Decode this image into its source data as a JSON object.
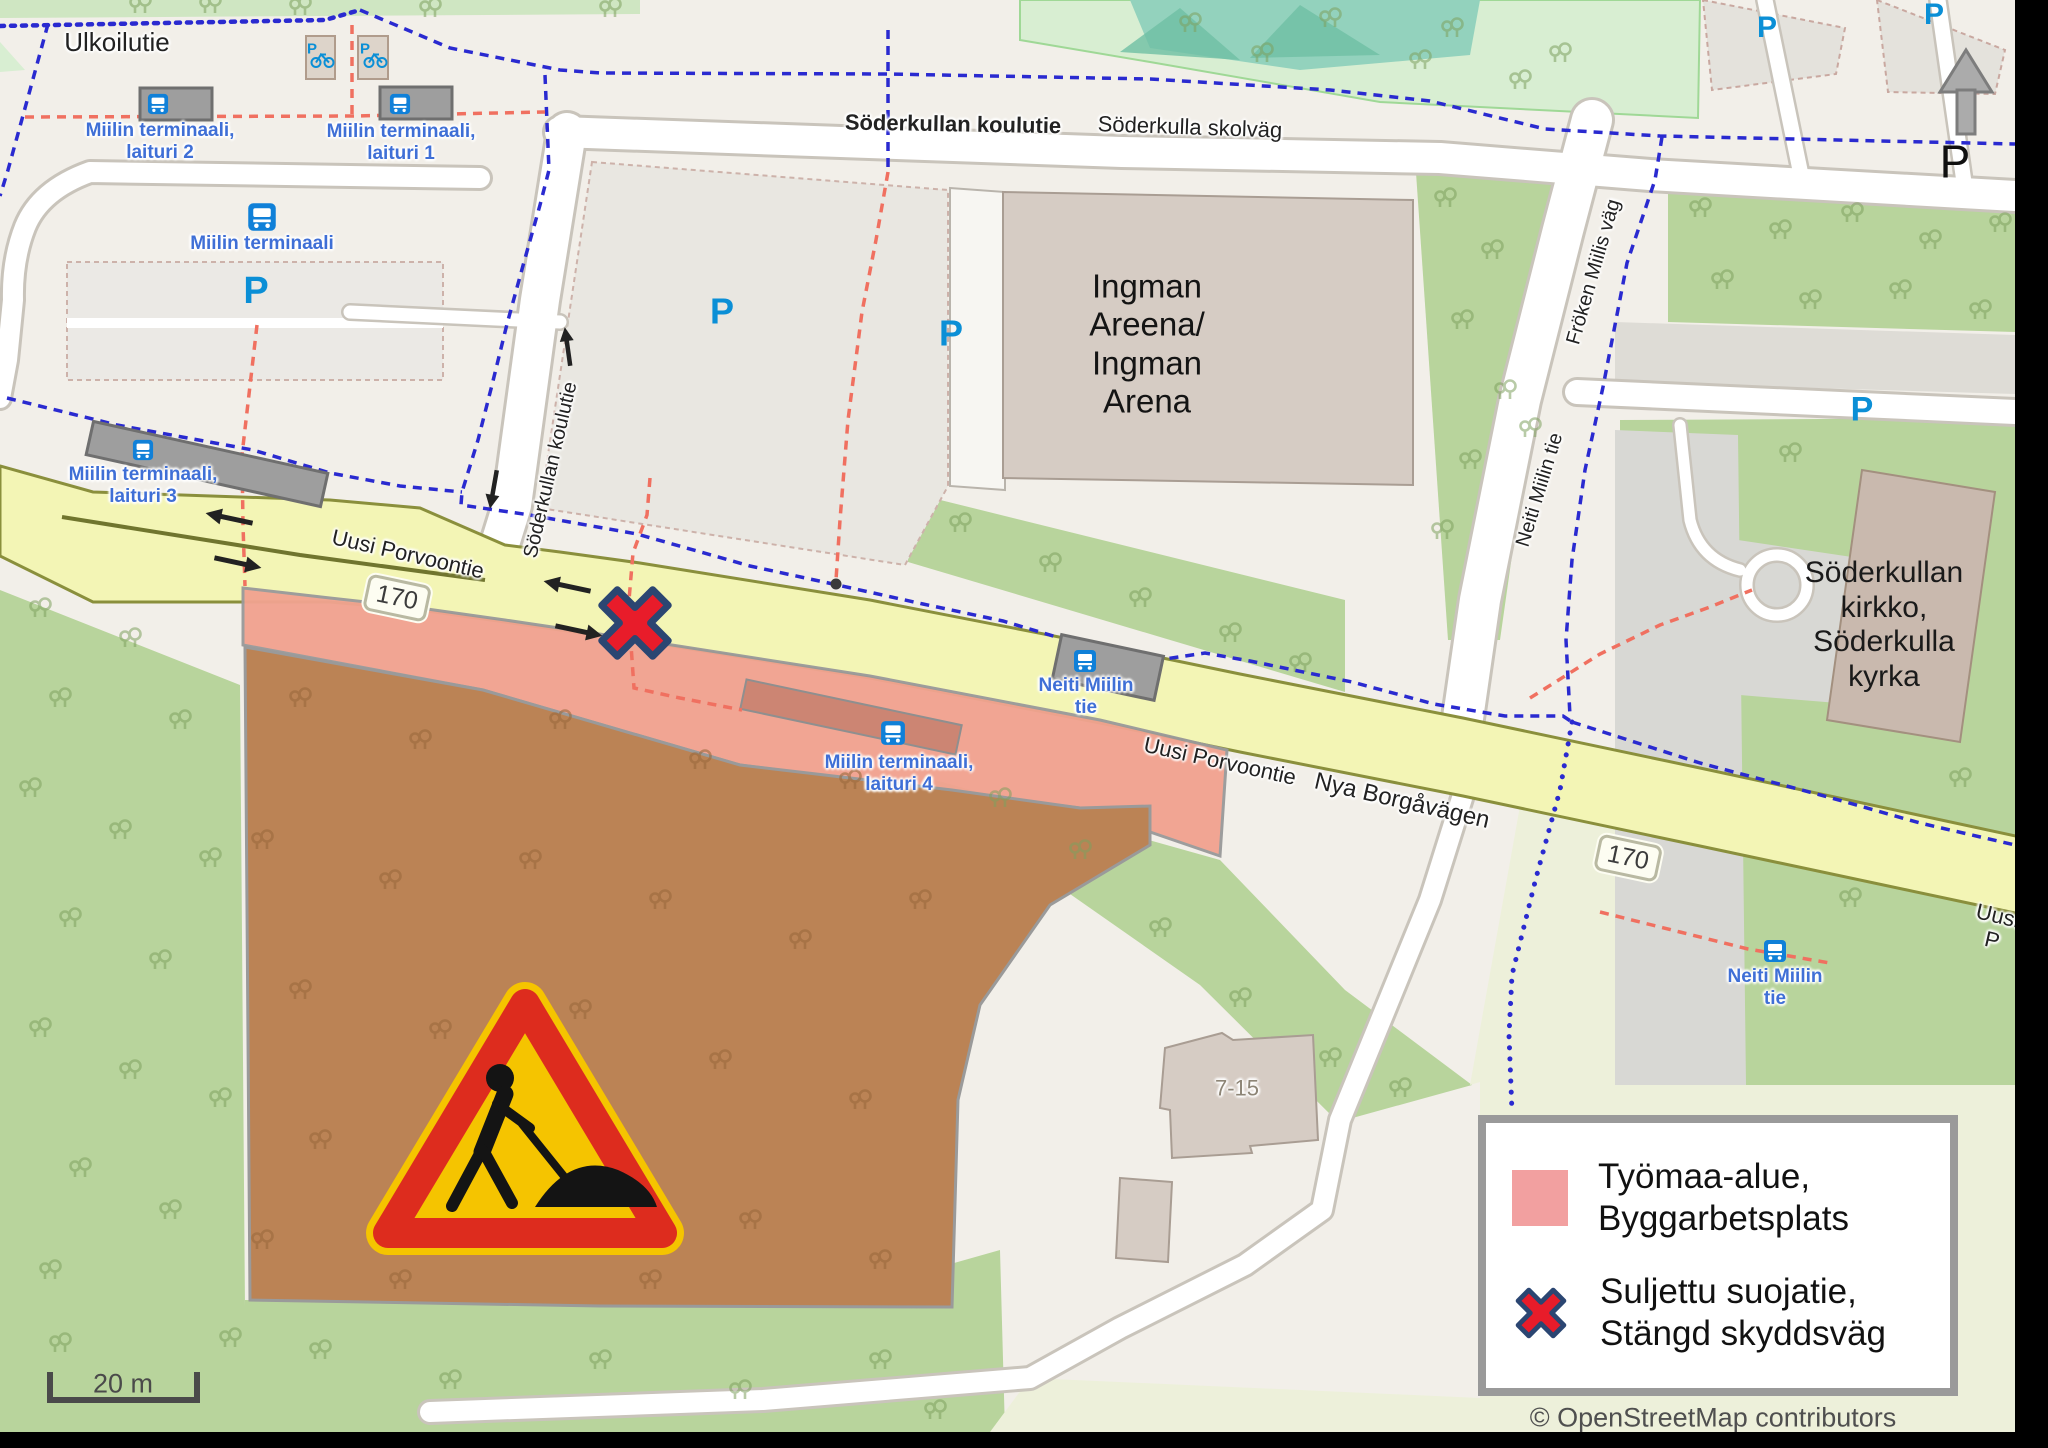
{
  "colors": {
    "base": "#f2efe9",
    "grass": "#b8d49c",
    "mint": "#d8eed2",
    "teal": "#93d2bd",
    "teal_dark": "#6fbfa4",
    "olive_pale": "#edf0da",
    "work_area_fill": "#f1a390",
    "construction_brown": "#bb8355",
    "road_yellow": "#f3f5b5",
    "road_yellow_border": "#8a8f3c",
    "white_road": "#ffffff",
    "casing": "#c9c4bb",
    "lot_gray": "#e9e7e1",
    "lot_border": "#cdb2aa",
    "building": "#d6ccc4",
    "building_border": "#a99d93",
    "shelter_gray": "#9e9e9e",
    "platform_red": "#cc8573",
    "legend_swatch": "#f2a0a0",
    "closed_x_red": "#e81c2a",
    "closed_x_outline": "#2b4672",
    "blue_dash": "#2a2ad0",
    "red_dash": "#f07060",
    "stop_blue": "#3f6fd6",
    "p_blue": "#0b8fd6",
    "sign_yellow": "#f5c400",
    "sign_red": "#dd2c1e"
  },
  "map": {
    "street_labels": [
      {
        "text": "Ulkoilutie",
        "x": 117,
        "y": 43,
        "rot": 0,
        "size": 26,
        "cls": ""
      },
      {
        "text": "Söderkullan koulutie",
        "x": 953,
        "y": 124,
        "rot": 1,
        "size": 22,
        "cls": "bold"
      },
      {
        "text": "Söderkulla skolväg",
        "x": 1190,
        "y": 127,
        "rot": 2,
        "size": 22,
        "cls": ""
      },
      {
        "text": "Söderkullan koulutie",
        "x": 551,
        "y": 470,
        "rot": -77,
        "size": 20,
        "cls": ""
      },
      {
        "text": "Fröken Miilis väg",
        "x": 1594,
        "y": 272,
        "rot": -74,
        "size": 20,
        "cls": ""
      },
      {
        "text": "Neiti Miilin tie",
        "x": 1540,
        "y": 490,
        "rot": -73,
        "size": 20,
        "cls": ""
      },
      {
        "text": "Uusi Porvoontie",
        "x": 408,
        "y": 554,
        "rot": 13,
        "size": 22,
        "cls": ""
      },
      {
        "text": "Uusi Porvoontie",
        "x": 1220,
        "y": 761,
        "rot": 12.5,
        "size": 22,
        "cls": ""
      },
      {
        "text": "Nya Borgåvägen",
        "x": 1402,
        "y": 801,
        "rot": 13,
        "size": 24,
        "cls": ""
      },
      {
        "text": "Uusi P",
        "x": 1995,
        "y": 928,
        "rot": 13,
        "size": 22,
        "cls": ""
      }
    ],
    "place_labels": [
      {
        "text": "Ingman\nAreena/\nIngman\nArena",
        "x": 1147,
        "y": 344,
        "rot": 0,
        "cls": "place"
      },
      {
        "text": "Söderkullan kirkko,\nSöderkulla kyrka",
        "x": 1884,
        "y": 625,
        "rot": 0,
        "cls": "church"
      },
      {
        "text": "7-15",
        "x": 1237,
        "y": 1088,
        "rot": 0,
        "cls": "addr"
      }
    ],
    "stop_labels": [
      {
        "text": "Miilin terminaali,\nlaituri 2",
        "x": 160,
        "y": 142
      },
      {
        "text": "Miilin terminaali,\nlaituri 1",
        "x": 401,
        "y": 143
      },
      {
        "text": "Miilin terminaali",
        "x": 262,
        "y": 244
      },
      {
        "text": "Miilin terminaali,\nlaituri 3",
        "x": 143,
        "y": 486
      },
      {
        "text": "Neiti Miilin\ntie",
        "x": 1086,
        "y": 697
      },
      {
        "text": "Miilin terminaali,\nlaituri 4",
        "x": 899,
        "y": 774
      },
      {
        "text": "Neiti Miilin\ntie",
        "x": 1775,
        "y": 988
      }
    ],
    "bus_icons": [
      {
        "x": 158,
        "y": 104,
        "s": 22
      },
      {
        "x": 400,
        "y": 104,
        "s": 22
      },
      {
        "x": 262,
        "y": 217,
        "s": 30
      },
      {
        "x": 143,
        "y": 450,
        "s": 22
      },
      {
        "x": 1085,
        "y": 661,
        "s": 24
      },
      {
        "x": 893,
        "y": 733,
        "s": 26
      },
      {
        "x": 1775,
        "y": 951,
        "s": 24
      }
    ],
    "bike_parking": [
      {
        "x": 320,
        "y": 57
      },
      {
        "x": 373,
        "y": 57
      }
    ],
    "parking_marks": [
      {
        "x": 256,
        "y": 292,
        "size": 38,
        "variant": "blue"
      },
      {
        "x": 722,
        "y": 311,
        "size": 36,
        "variant": "blue"
      },
      {
        "x": 951,
        "y": 333,
        "size": 36,
        "variant": "blue"
      },
      {
        "x": 1862,
        "y": 410,
        "size": 34,
        "variant": "blue"
      },
      {
        "x": 1767,
        "y": 28,
        "size": 30,
        "variant": "blue"
      },
      {
        "x": 1934,
        "y": 15,
        "size": 30,
        "variant": "blue"
      },
      {
        "x": 1955,
        "y": 162,
        "size": 46,
        "variant": "black"
      }
    ],
    "route_shields": [
      {
        "text": "170",
        "x": 397,
        "y": 598,
        "rot": 12
      },
      {
        "text": "170",
        "x": 1628,
        "y": 858,
        "rot": 12
      }
    ],
    "legend": {
      "items": [
        {
          "type": "work-area",
          "label": "Työmaa-alue,\nByggarbetsplats"
        },
        {
          "type": "closed-crossing",
          "label": "Suljettu suojatie,\nStängd skyddsväg"
        }
      ]
    },
    "scale_bar": {
      "label": "20 m"
    },
    "attribution": "© OpenStreetMap contributors",
    "trees_green": [
      [
        140,
        6
      ],
      [
        210,
        6
      ],
      [
        300,
        8
      ],
      [
        430,
        10
      ],
      [
        610,
        10
      ],
      [
        1190,
        25
      ],
      [
        1262,
        55
      ],
      [
        1330,
        20
      ],
      [
        1420,
        62
      ],
      [
        1452,
        30
      ],
      [
        1520,
        82
      ],
      [
        1560,
        55
      ],
      [
        1445,
        200
      ],
      [
        1492,
        252
      ],
      [
        1462,
        322
      ],
      [
        1505,
        392
      ],
      [
        1470,
        462
      ],
      [
        1442,
        532
      ],
      [
        1530,
        430
      ],
      [
        960,
        525
      ],
      [
        1050,
        565
      ],
      [
        1140,
        600
      ],
      [
        1230,
        635
      ],
      [
        1300,
        665
      ],
      [
        1700,
        210
      ],
      [
        1780,
        232
      ],
      [
        1852,
        215
      ],
      [
        1930,
        242
      ],
      [
        2000,
        225
      ],
      [
        1722,
        282
      ],
      [
        1810,
        302
      ],
      [
        1900,
        292
      ],
      [
        1980,
        312
      ],
      [
        40,
        610
      ],
      [
        130,
        640
      ],
      [
        60,
        700
      ],
      [
        180,
        722
      ],
      [
        30,
        790
      ],
      [
        120,
        832
      ],
      [
        210,
        860
      ],
      [
        70,
        920
      ],
      [
        160,
        962
      ],
      [
        40,
        1030
      ],
      [
        130,
        1072
      ],
      [
        220,
        1100
      ],
      [
        80,
        1170
      ],
      [
        170,
        1212
      ],
      [
        50,
        1272
      ],
      [
        60,
        1345
      ],
      [
        230,
        1340
      ],
      [
        320,
        1352
      ],
      [
        450,
        1382
      ],
      [
        600,
        1362
      ],
      [
        740,
        1392
      ],
      [
        880,
        1362
      ],
      [
        935,
        1412
      ],
      [
        1000,
        800
      ],
      [
        1080,
        852
      ],
      [
        1160,
        930
      ],
      [
        1240,
        1000
      ],
      [
        1330,
        1060
      ],
      [
        1400,
        1090
      ],
      [
        1790,
        455
      ],
      [
        1960,
        780
      ],
      [
        1850,
        900
      ]
    ],
    "trees_brown": [
      [
        300,
        700
      ],
      [
        420,
        742
      ],
      [
        560,
        722
      ],
      [
        700,
        762
      ],
      [
        850,
        782
      ],
      [
        262,
        842
      ],
      [
        390,
        882
      ],
      [
        530,
        862
      ],
      [
        660,
        902
      ],
      [
        800,
        942
      ],
      [
        920,
        902
      ],
      [
        300,
        992
      ],
      [
        440,
        1032
      ],
      [
        580,
        1012
      ],
      [
        720,
        1062
      ],
      [
        860,
        1102
      ],
      [
        320,
        1142
      ],
      [
        470,
        1182
      ],
      [
        610,
        1162
      ],
      [
        750,
        1222
      ],
      [
        880,
        1262
      ],
      [
        262,
        1242
      ],
      [
        400,
        1282
      ],
      [
        650,
        1282
      ]
    ]
  }
}
